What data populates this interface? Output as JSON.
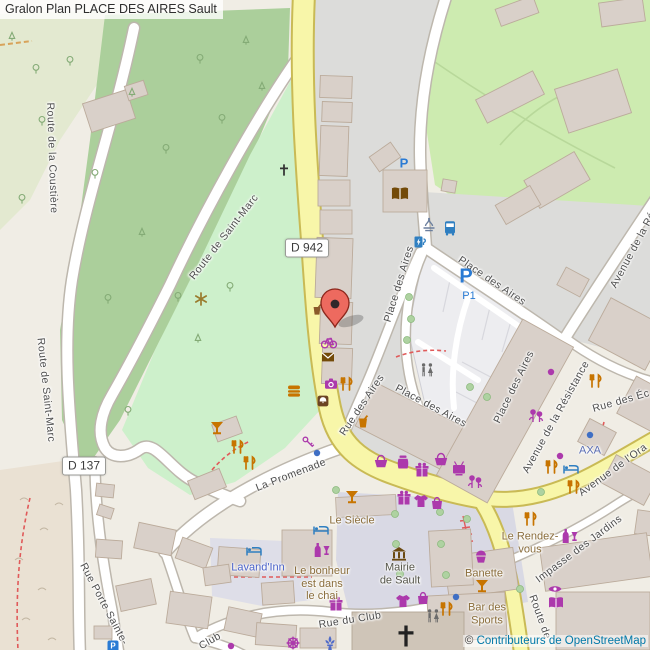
{
  "title": "Gralon Plan PLACE DES AIRES Sault",
  "attribution": {
    "copyright": "©",
    "link_text": "Contributeurs de OpenStreetMap"
  },
  "shields": {
    "d942": "D 942",
    "d137": "D 137"
  },
  "parking": {
    "p_large": "P",
    "p1": "P1",
    "p_small": "P",
    "p_tiny": "P"
  },
  "streets": [
    {
      "id": "route-de-la-coustiere",
      "text": "Route de la Coustière"
    },
    {
      "id": "route-de-saint-marc-w",
      "text": "Route de Saint-Marc"
    },
    {
      "id": "route-de-saint-marc",
      "text": "Route de Saint-Marc"
    },
    {
      "id": "place-des-aires-nw",
      "text": "Place des Aires"
    },
    {
      "id": "place-des-aires-ne",
      "text": "Place des Aires"
    },
    {
      "id": "place-des-aires-se",
      "text": "Place des Aires"
    },
    {
      "id": "place-des-aires-s",
      "text": "Place des Aires"
    },
    {
      "id": "rue-des-aires",
      "text": "Rue des Aires"
    },
    {
      "id": "avenue-de-la-resistance",
      "text": "Avenue de la Résistance"
    },
    {
      "id": "avenue-de-la-resistance-top",
      "text": "Avenue de la Ré"
    },
    {
      "id": "rue-des-ecoles",
      "text": "Rue des Éc"
    },
    {
      "id": "avenue-de-l-orange",
      "text": "Avenue de l'Ora"
    },
    {
      "id": "impasse-des-jardins",
      "text": "Impasse des Jardins"
    },
    {
      "id": "route-de-sud",
      "text": "Route de"
    },
    {
      "id": "la-promenade",
      "text": "La Promenade"
    },
    {
      "id": "rue-du-club",
      "text": "Rue du Club"
    },
    {
      "id": "club",
      "text": "Club"
    },
    {
      "id": "rue-porte-sainte",
      "text": "Rue Porte Sainte-"
    }
  ],
  "pois": [
    {
      "id": "le-siecle",
      "text": "Le Siècle"
    },
    {
      "id": "lavand-inn",
      "text": "Lavand'Inn"
    },
    {
      "id": "le-bonheur",
      "text": "Le bonheur\nest dans\nle chai"
    },
    {
      "id": "mairie-de-sault",
      "text": "Mairie\nde Sault"
    },
    {
      "id": "le-rendez-vous",
      "text": "Le Rendez-\nvous"
    },
    {
      "id": "banette",
      "text": "Banette"
    },
    {
      "id": "bar-des-sports",
      "text": "Bar des\nSports"
    },
    {
      "id": "axa",
      "text": "AXA"
    }
  ],
  "icons": {
    "marker-icon": "red map pin",
    "bus-stop-icon": "bus stop",
    "charging-station-icon": "EV charging",
    "fountain-icon": "fountain",
    "parking-icon": "parking P",
    "library-icon": "open book",
    "post-icon": "envelope",
    "restaurant-icon": "fork and knife",
    "bar-icon": "cocktail glass",
    "fast-food-icon": "burger",
    "cafe-icon": "cup",
    "wine-shop-icon": "bottle and glass",
    "shop-icon": "purple dot",
    "basket-icon": "supermarket basket",
    "gift-icon": "gift box",
    "clothes-icon": "t-shirt",
    "tv-icon": "television",
    "photo-icon": "camera",
    "bike-icon": "bicycle",
    "florist-icon": "flowers",
    "bakery-icon": "cupcake",
    "optician-icon": "eye",
    "hotel-icon": "bed",
    "toilets-icon": "toilets figures",
    "townhall-icon": "town hall",
    "church-cross-icon": "christian cross",
    "viewpoint-icon": "asterisk star",
    "key-icon": "key",
    "bag-icon": "handbag",
    "jar-icon": "jar",
    "wheel-icon": "wheel",
    "fleur-icon": "fleur-de-lis"
  },
  "colors": {
    "road_primary": "#f8f6a9",
    "road_primary_casing": "#c9ba55",
    "road_white": "#ffffff",
    "road_casing": "#bdb7ad",
    "forest": "#abcf9b",
    "grass": "#cdebb0",
    "park": "#cdf0cb",
    "pedestrian_square": "#d9d9e4",
    "building": "#d9d0c9",
    "parking_area": "#ededf0",
    "poi_shopping": "#ac39ac",
    "poi_food": "#c77400",
    "poi_transport": "#2f7fc1",
    "poi_culture": "#734a08",
    "marker": "#ed6a5f",
    "street_label": "#4d4d4d",
    "poi_label_brown": "#8a6d3b",
    "poi_label_blue": "#4a62c9",
    "attribution_link": "#0078a8"
  }
}
